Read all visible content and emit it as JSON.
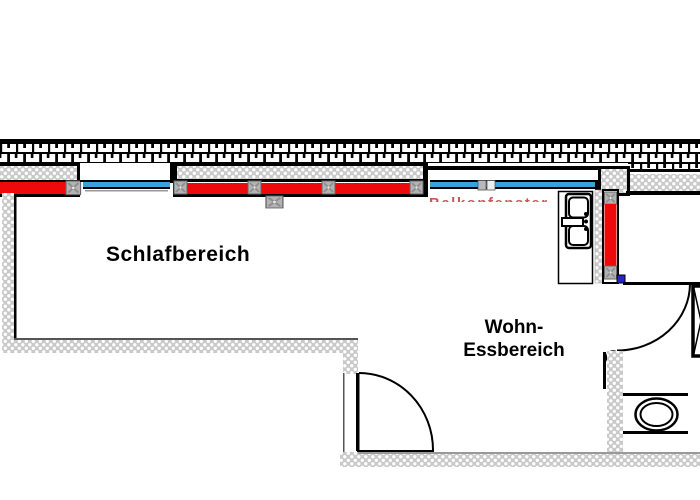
{
  "floorplan": {
    "rooms": {
      "bedroom": {
        "label": "Schlafbereich"
      },
      "living_dining": {
        "label_line1": "Wohn-",
        "label_line2": "Essbereich"
      }
    },
    "clipped_red_window_label": "Balkonfenster",
    "colors": {
      "radiator_red": "#ee0a0a",
      "window_glass_blue": "#36a3d9",
      "door_hinge_blue": "#2424c8",
      "wall_fill_gray": "#c9c9c9",
      "outline_black": "#000000"
    },
    "fixture_icons": [
      "brick-exterior-wall-icon",
      "radiator-icon",
      "window-glass-icon",
      "kitchen-sink-icon",
      "toilet-icon",
      "door-swing-icon",
      "door-hinge-dot-icon",
      "shaft-cross-box-icon"
    ]
  }
}
